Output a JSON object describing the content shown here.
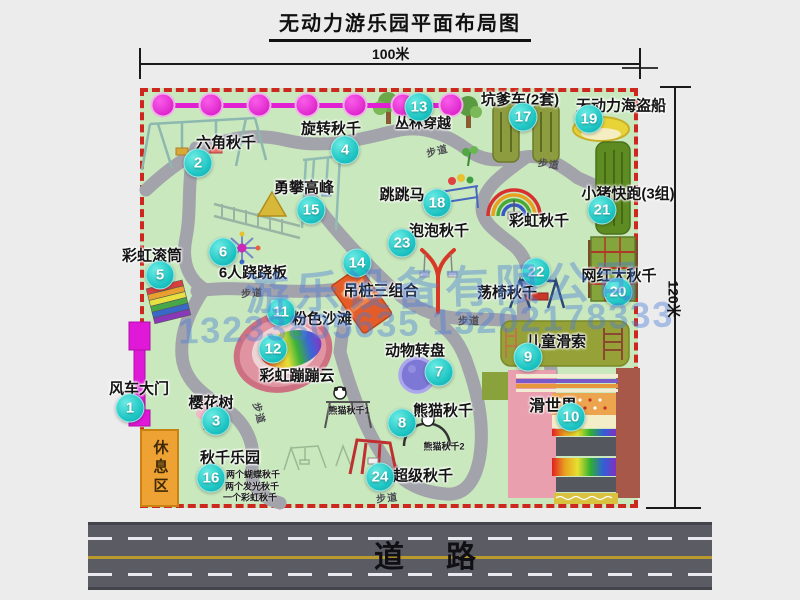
{
  "page": {
    "title": "无动力游乐园平面布局图"
  },
  "dimensions": {
    "width_label": "100米",
    "height_label": "120米"
  },
  "road": {
    "label": "道　路"
  },
  "rest_area": {
    "label": "休息区"
  },
  "watermark": {
    "line1": "游乐设备有限公司",
    "line2": "13233805635 13202178333"
  },
  "colors": {
    "map_green": "#c9e8bd",
    "border_red": "#cd2820",
    "number_circle_teal": "#1fc6c4",
    "zipline_magenta": "#e020d2",
    "gate_magenta": "#e018d8",
    "rest_area_orange": "#eda233",
    "road_gray": "#5b5b64",
    "road_line_yellow": "#b99a2e",
    "watermark_blue": "#4b7dd7",
    "path_gray": "#a3a3ac"
  },
  "map": {
    "attractions": [
      {
        "num": "1",
        "name": "风车大门",
        "nx": 130,
        "ny": 408,
        "lx": 139,
        "ly": 388
      },
      {
        "num": "2",
        "name": "六角秋千",
        "nx": 198,
        "ny": 163,
        "lx": 226,
        "ly": 142
      },
      {
        "num": "3",
        "name": "樱花树",
        "nx": 216,
        "ny": 421,
        "lx": 211,
        "ly": 402
      },
      {
        "num": "4",
        "name": "旋转秋千",
        "nx": 345,
        "ny": 150,
        "lx": 331,
        "ly": 128
      },
      {
        "num": "5",
        "name": "彩虹滚筒",
        "nx": 160,
        "ny": 275,
        "lx": 152,
        "ly": 255
      },
      {
        "num": "6",
        "name": "6人跷跷板",
        "nx": 223,
        "ny": 252,
        "lx": 253,
        "ly": 272
      },
      {
        "num": "7",
        "name": "动物转盘",
        "nx": 439,
        "ny": 372,
        "lx": 415,
        "ly": 350
      },
      {
        "num": "8",
        "name": "熊猫秋千",
        "nx": 402,
        "ny": 423,
        "lx": 443,
        "ly": 410
      },
      {
        "num": "9",
        "name": "儿童滑索",
        "nx": 528,
        "ny": 357,
        "lx": 556,
        "ly": 341
      },
      {
        "num": "10",
        "name": "滑世界",
        "nx": 571,
        "ny": 417,
        "lx": 553,
        "ly": 404,
        "fs": 16
      },
      {
        "num": "11",
        "name": "粉色沙滩",
        "nx": 281,
        "ny": 312,
        "lx": 322,
        "ly": 318
      },
      {
        "num": "12",
        "name": "彩虹蹦蹦云",
        "nx": 273,
        "ny": 349,
        "lx": 297,
        "ly": 375
      },
      {
        "num": "13",
        "name": "丛林穿越",
        "nx": 419,
        "ny": 107,
        "lx": 423,
        "ly": 123,
        "fs": 14
      },
      {
        "num": "14",
        "name": "吊桩三组合",
        "nx": 357,
        "ny": 263,
        "lx": 381,
        "ly": 290
      },
      {
        "num": "15",
        "name": "勇攀高峰",
        "nx": 311,
        "ny": 210,
        "lx": 304,
        "ly": 187
      },
      {
        "num": "16",
        "name": "秋千乐园",
        "nx": 211,
        "ny": 478,
        "lx": 230,
        "ly": 457
      },
      {
        "num": "17",
        "name": "坑爹车(2套)",
        "nx": 523,
        "ny": 117,
        "lx": 520,
        "ly": 99
      },
      {
        "num": "18",
        "name": "跳跳马",
        "nx": 437,
        "ny": 203,
        "lx": 402,
        "ly": 194
      },
      {
        "num": "19",
        "name": "无动力海盗船",
        "nx": 589,
        "ny": 119,
        "lx": 621,
        "ly": 105
      },
      {
        "num": "20",
        "name": "网红大秋千",
        "nx": 618,
        "ny": 292,
        "lx": 619,
        "ly": 275
      },
      {
        "num": "21",
        "name": "小猪快跑(3组)",
        "nx": 602,
        "ny": 210,
        "lx": 628,
        "ly": 193
      },
      {
        "num": "22",
        "name": "荡椅秋千",
        "nx": 536,
        "ny": 272,
        "lx": 507,
        "ly": 292
      },
      {
        "num": "23",
        "name": "泡泡秋千",
        "nx": 402,
        "ny": 243,
        "lx": 439,
        "ly": 230
      },
      {
        "num": "24",
        "name": "超级秋千",
        "nx": 380,
        "ny": 477,
        "lx": 423,
        "ly": 475
      },
      {
        "num": "",
        "name": "彩虹秋千",
        "nx": 0,
        "ny": 0,
        "lx": 539,
        "ly": 220
      }
    ],
    "sub_labels": [
      {
        "text": "熊猫秋千1",
        "x": 349,
        "y": 410
      },
      {
        "text": "熊猫秋千2",
        "x": 444,
        "y": 446
      },
      {
        "text": "两个蝴蝶秋千",
        "x": 253,
        "y": 474
      },
      {
        "text": "两个发光秋千",
        "x": 252,
        "y": 486
      },
      {
        "text": "一个彩虹秋千",
        "x": 250,
        "y": 497
      }
    ],
    "trail_labels": [
      {
        "text": "步道",
        "x": 437,
        "y": 150,
        "rot": -14
      },
      {
        "text": "步道",
        "x": 549,
        "y": 163,
        "rot": 8
      },
      {
        "text": "步道",
        "x": 252,
        "y": 292,
        "rot": -4
      },
      {
        "text": "步道",
        "x": 469,
        "y": 320,
        "rot": 0
      },
      {
        "text": "步道",
        "x": 260,
        "y": 413,
        "rot": 75
      },
      {
        "text": "步道",
        "x": 387,
        "y": 497,
        "rot": -6
      }
    ],
    "zipline": {
      "y": 105,
      "x1": 152,
      "x2": 460,
      "dot_xs": [
        163,
        211,
        259,
        307,
        355,
        403,
        451
      ]
    }
  }
}
